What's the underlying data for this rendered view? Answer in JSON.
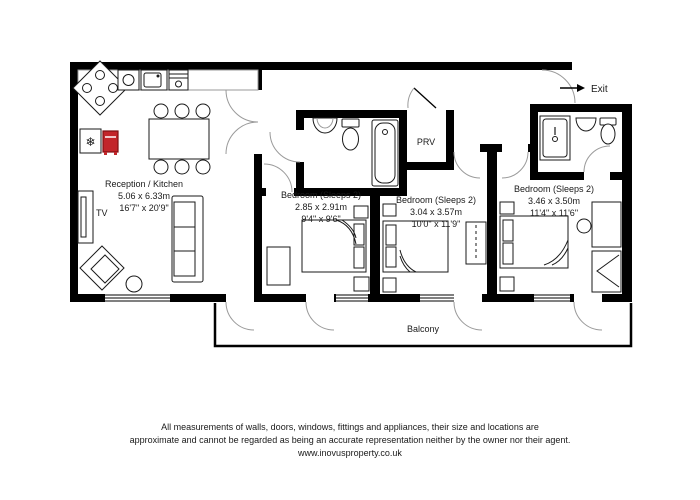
{
  "plan": {
    "rooms": {
      "reception": {
        "name": "Reception / Kitchen",
        "metric": "5.06 x 6.33m",
        "imperial": "16'7\" x 20'9\""
      },
      "bedroom1": {
        "name": "Bedroom (Sleeps 2)",
        "metric": "2.85 x 2.91m",
        "imperial": "9'4\" x 9'6\""
      },
      "bedroom2": {
        "name": "Bedroom (Sleeps 2)",
        "metric": "3.04 x 3.57m",
        "imperial": "10'0\" x 11'9\""
      },
      "bedroom3": {
        "name": "Bedroom (Sleeps 2)",
        "metric": "3.46 x 3.50m",
        "imperial": "11'4\" x 11'6\""
      },
      "prv": {
        "name": "PRV"
      },
      "balcony": {
        "name": "Balcony"
      }
    },
    "labels": {
      "tv": "TV",
      "exit": "Exit",
      "snowflake_icon": "❄"
    },
    "colors": {
      "wall": "#000000",
      "boiler_red": "#c2252a",
      "door_arc": "#9a9a9a"
    },
    "footer": {
      "line1": "All measurements of walls, doors, windows, fittings and appliances, their size and locations are",
      "line2": "approximate and cannot be regarded as being an accurate representation neither by the owner nor their agent.",
      "line3": "www.inovusproperty.co.uk"
    }
  }
}
